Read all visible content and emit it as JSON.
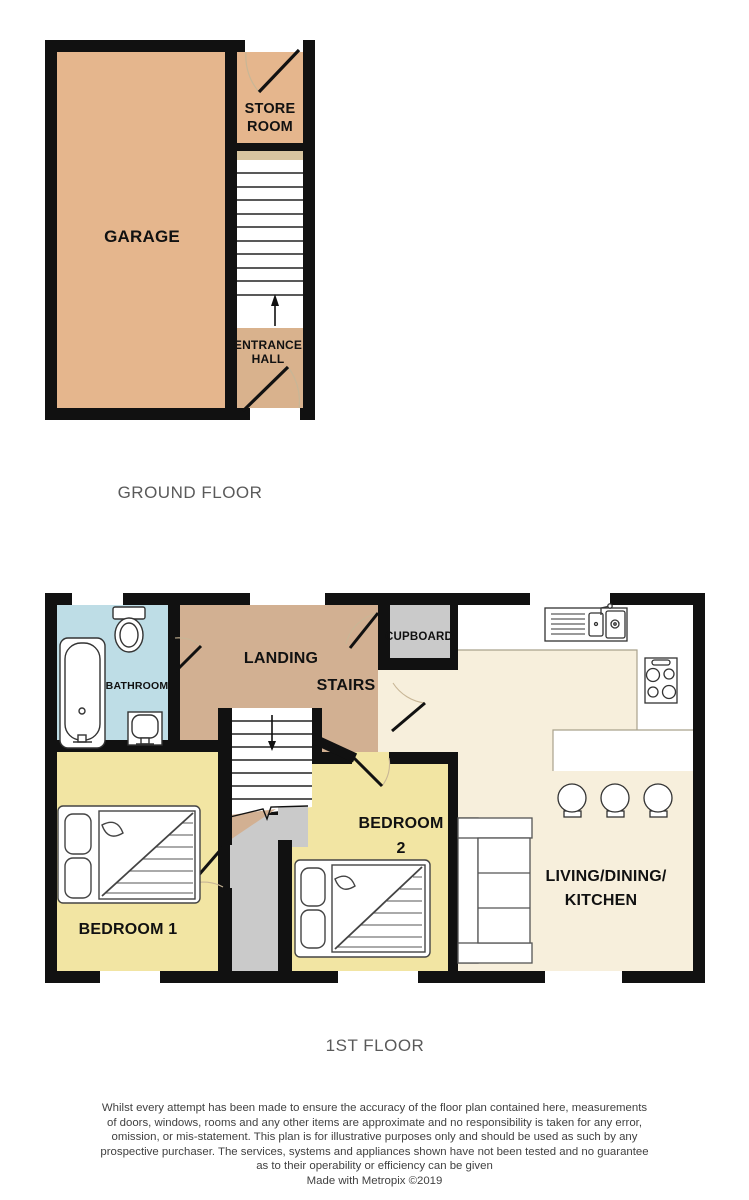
{
  "ground_floor": {
    "caption": "GROUND FLOOR",
    "rooms": {
      "garage": "GARAGE",
      "store_room_line1": "STORE",
      "store_room_line2": "ROOM",
      "entrance_hall_line1": "ENTRANCE",
      "entrance_hall_line2": "HALL"
    }
  },
  "first_floor": {
    "caption": "1ST FLOOR",
    "rooms": {
      "bathroom": "BATHROOM",
      "landing": "LANDING",
      "stairs": "STAIRS",
      "cupboard": "CUPBOARD",
      "bedroom1": "BEDROOM 1",
      "bedroom2_line1": "BEDROOM",
      "bedroom2_line2": "2",
      "living_line1": "LIVING/DINING/",
      "living_line2": "KITCHEN"
    }
  },
  "footer": {
    "disclaimer_lines": [
      "Whilst every attempt has been made to ensure the accuracy of the floor plan contained here, measurements",
      "of doors, windows, rooms and any other items are approximate and no responsibility is taken for any error,",
      "omission, or mis-statement. This plan is for illustrative purposes only and should be used as such by any",
      "prospective purchaser. The services, systems and appliances shown have not been tested and no guarantee",
      "as to their operability or efficiency can be given"
    ],
    "credit": "Made with Metropix ©2019"
  },
  "colors": {
    "wall": "#111111",
    "garage_tan": "#e5b68d",
    "entrance_tan": "#d9b28d",
    "landing_brown": "#d2b092",
    "stair_top_beige": "#d8c5a0",
    "bedroom_yellow": "#f2e5a3",
    "bathroom_blue": "#bedde6",
    "living_cream": "#f7efdc",
    "cupboard_gray": "#cacaca",
    "door_arc": "#c8b696",
    "caption_gray": "#5a5a5a"
  }
}
